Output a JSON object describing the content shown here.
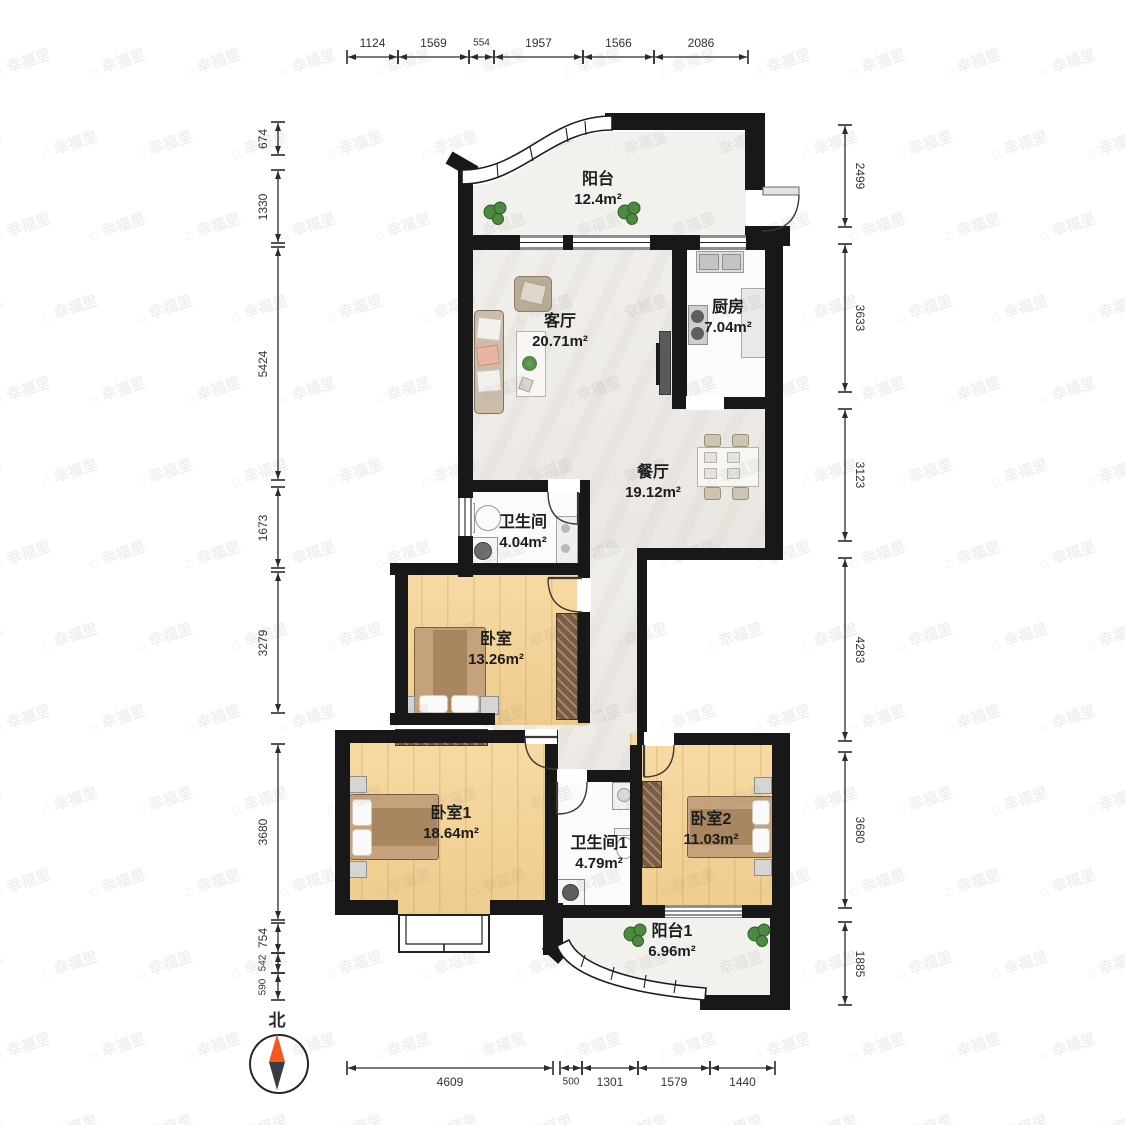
{
  "watermark": {
    "text": "幸福里"
  },
  "compass": {
    "north_label": "北"
  },
  "dimensions": {
    "top": [
      "1124",
      "1569",
      "554",
      "1957",
      "1566",
      "2086"
    ],
    "left": [
      "674",
      "1330",
      "5424",
      "1673",
      "3279",
      "3680",
      "754",
      "542",
      "590"
    ],
    "right": [
      "2499",
      "3633",
      "3123",
      "4283",
      "3680",
      "1885"
    ],
    "bottom": [
      "4609",
      "500",
      "1301",
      "1579",
      "1440"
    ]
  },
  "rooms": [
    {
      "name": "阳台",
      "area": "12.4m²"
    },
    {
      "name": "客厅",
      "area": "20.71m²"
    },
    {
      "name": "厨房",
      "area": "7.04m²"
    },
    {
      "name": "餐厅",
      "area": "19.12m²"
    },
    {
      "name": "卫生间",
      "area": "4.04m²"
    },
    {
      "name": "卧室",
      "area": "13.26m²"
    },
    {
      "name": "卧室1",
      "area": "18.64m²"
    },
    {
      "name": "卫生间1",
      "area": "4.79m²"
    },
    {
      "name": "卧室2",
      "area": "11.03m²"
    },
    {
      "name": "阳台1",
      "area": "6.96m²"
    }
  ],
  "colors": {
    "wall": "#181818",
    "wood_floor": "#f3d194",
    "marble_floor": "#efedea",
    "wardrobe": "#7b5b40",
    "compass_north": "#f4581f",
    "dimension_text": "#333333",
    "plant": "#4d8a41"
  }
}
